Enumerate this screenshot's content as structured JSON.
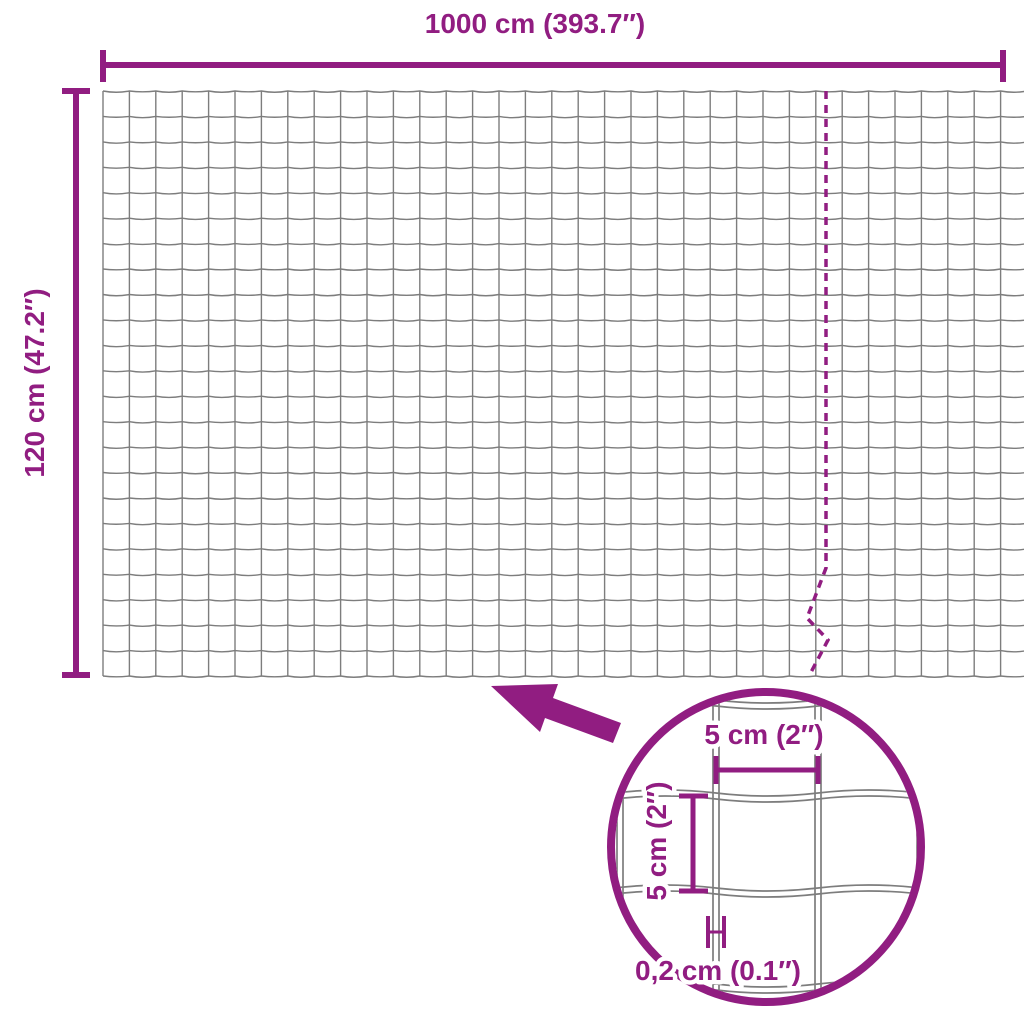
{
  "diagram": {
    "colors": {
      "accent": "#911d81",
      "wire": "#7d7d7d",
      "background": "#ffffff"
    },
    "overall": {
      "width_label": "1000 cm (393.7″)",
      "height_label": "120 cm (47.2″)"
    },
    "detail_view": {
      "mesh_opening_width_label": "5 cm (2″)",
      "mesh_opening_height_label": "5 cm (2″)",
      "wire_thickness_label": "0,2 cm (0.1″)"
    }
  }
}
